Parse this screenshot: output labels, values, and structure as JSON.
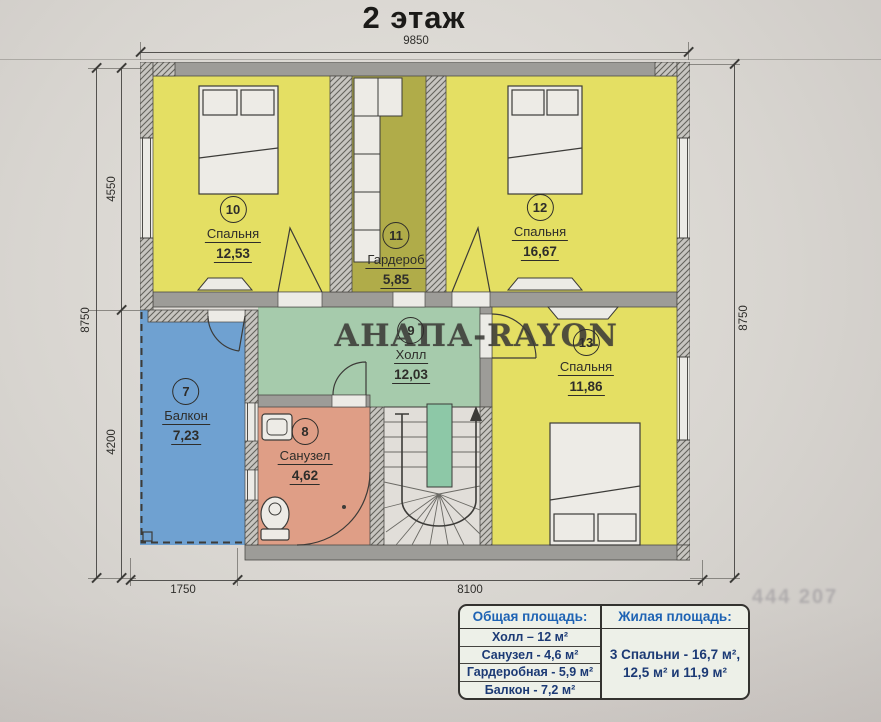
{
  "title": "2 этаж",
  "watermark": "АНАПА-RAYON",
  "ghost_text": "444 207",
  "dimensions": {
    "top": "9850",
    "left_outer": "8750",
    "left_upper": "4550",
    "left_lower": "4200",
    "right": "8750",
    "bottom_left": "1750",
    "bottom_right": "8100"
  },
  "rooms": {
    "balcony7": {
      "number": "7",
      "name": "Балкон",
      "area": "7,23"
    },
    "bathroom8": {
      "number": "8",
      "name": "Санузел",
      "area": "4,62"
    },
    "hall9": {
      "number": "9",
      "name": "Холл",
      "area": "12,03"
    },
    "bedroom10": {
      "number": "10",
      "name": "Спальня",
      "area": "12,53"
    },
    "wardrobe11": {
      "number": "11",
      "name": "Гардероб",
      "area": "5,85"
    },
    "bedroom12": {
      "number": "12",
      "name": "Спальня",
      "area": "16,67"
    },
    "bedroom13": {
      "number": "13",
      "name": "Спальня",
      "area": "11,86"
    }
  },
  "legend": {
    "total_header": "Общая площадь:",
    "total_rows": [
      "Холл – 12 м²",
      "Санузел - 4,6 м²",
      "Гардеробная - 5,9 м²",
      "Балкон - 7,2 м²"
    ],
    "living_header": "Жилая площадь:",
    "living_lines": [
      "3 Спальни - 16,7 м²,",
      "12,5 м² и 11,9 м²"
    ]
  },
  "colors": {
    "yellow": "#e4df63",
    "olive": "#b0ac49",
    "green": "#a6cbac",
    "stairgreen": "#8dc8a7",
    "blue": "#6fa1d1",
    "salmon": "#df9e86",
    "wall": "#9d9c98",
    "hatchbg": "#c7c5c0",
    "line": "#3c3b38",
    "legend-header": "#1e63b4",
    "legend-text": "#1c3a75"
  }
}
